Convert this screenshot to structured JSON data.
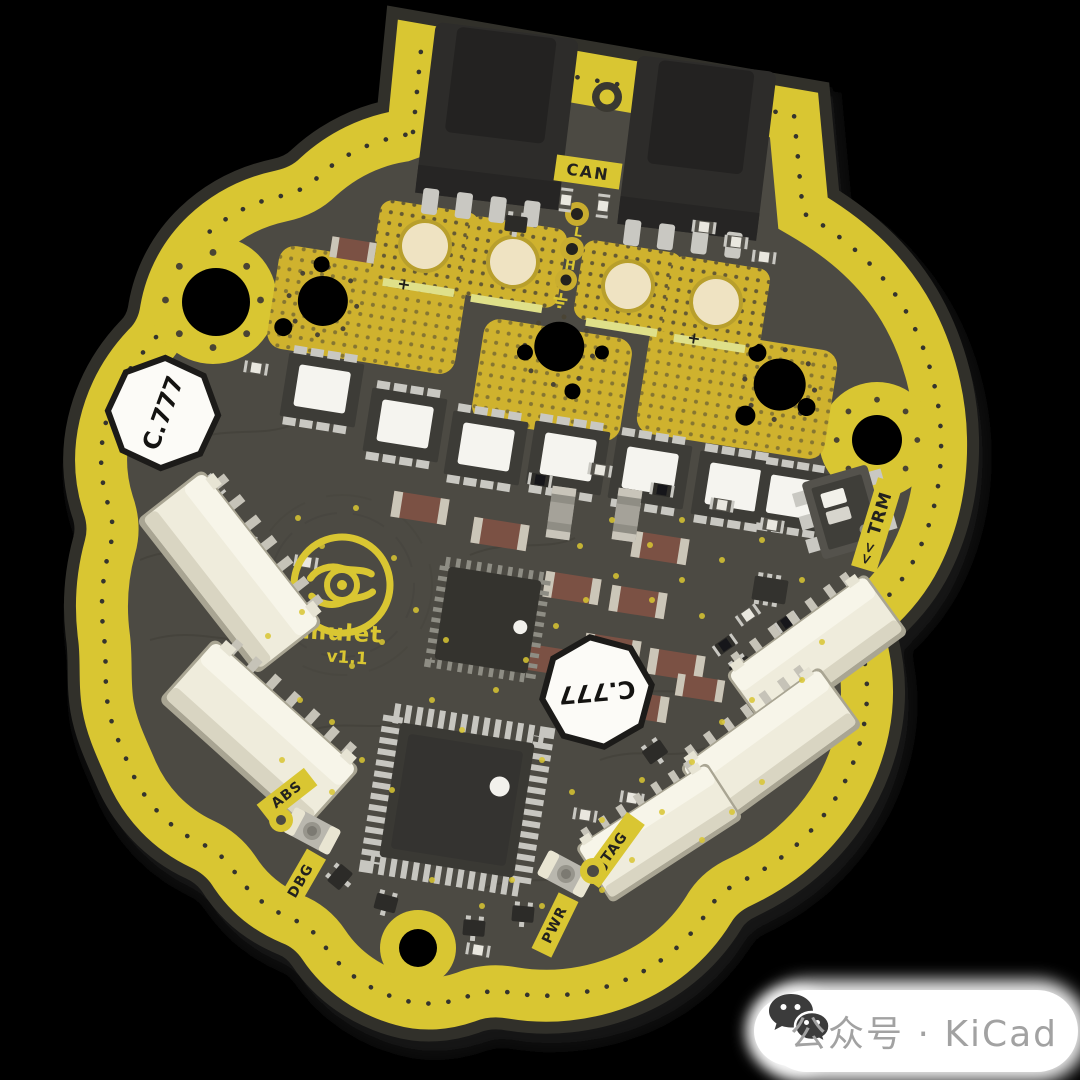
{
  "board": {
    "logo": {
      "name": "Amulet",
      "version": "v1.1"
    },
    "silkscreen": {
      "can": "CAN",
      "abs": "ABS",
      "dbg": "DBG",
      "jtag": "JTAG",
      "pwr": "PWR",
      "trm": "TRM",
      "trm_arrows": "<<",
      "phase_low": "L",
      "phase_high": "H",
      "plus_mark": "+"
    },
    "component_markings": {
      "inductor_top_left": "C.777",
      "inductor_center": "C.777"
    },
    "colors": {
      "soldermask_yellow": "#d9c632",
      "board_surface": "#4c4a43",
      "copper_gold": "#cfb22e",
      "pad_cream": "#efe3c2",
      "component_white": "#f5f4ef",
      "capacitor_brown": "#7b5144",
      "connector_cream": "#efecdc",
      "background": "#000000"
    }
  },
  "watermark": {
    "icon": "wechat-icon",
    "text": "公众号 · KiCad"
  }
}
